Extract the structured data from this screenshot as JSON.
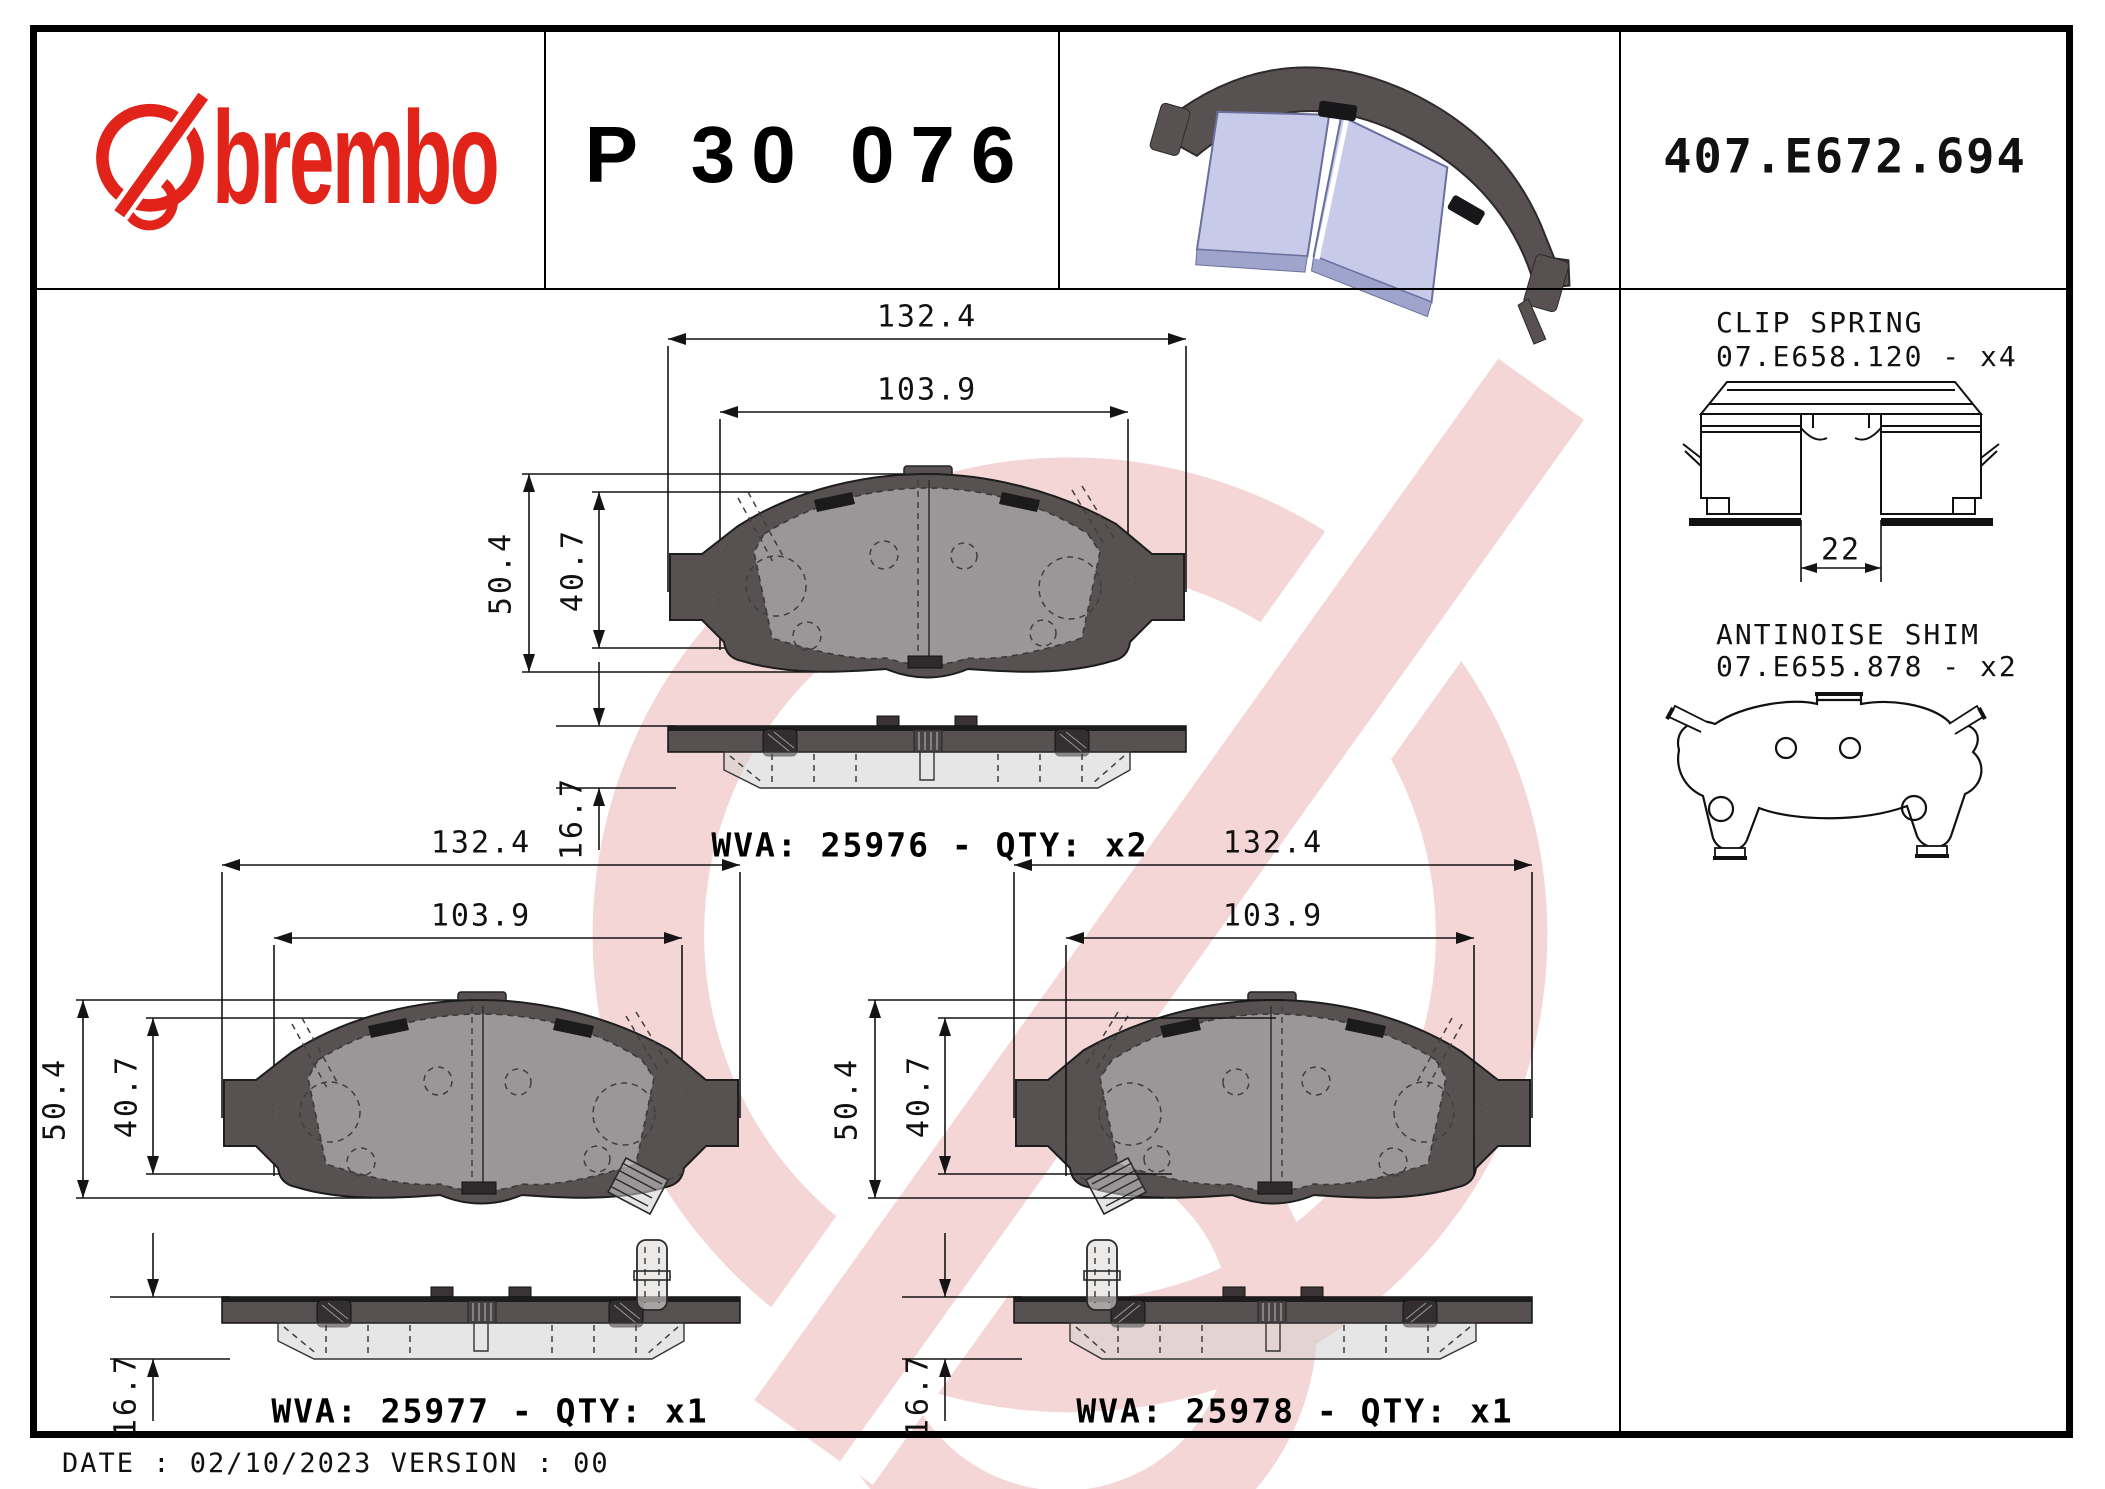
{
  "header": {
    "brand_word": "brembo",
    "part_number": "P 30 076",
    "catalog_code": "407.E672.694"
  },
  "pads": [
    {
      "wva_label": "WVA: 25976 - QTY: x2",
      "dim_width_outer": "132.4",
      "dim_width_inner": "103.9",
      "dim_height_outer": "50.4",
      "dim_height_inner": "40.7",
      "dim_thickness": "16.7"
    },
    {
      "wva_label": "WVA: 25977 - QTY: x1",
      "dim_width_outer": "132.4",
      "dim_width_inner": "103.9",
      "dim_height_outer": "50.4",
      "dim_height_inner": "40.7",
      "dim_thickness": "16.7"
    },
    {
      "wva_label": "WVA: 25978 - QTY: x1",
      "dim_width_outer": "132.4",
      "dim_width_inner": "103.9",
      "dim_height_outer": "50.4",
      "dim_height_inner": "40.7",
      "dim_thickness": "16.7"
    }
  ],
  "accessories": {
    "clip_spring": {
      "title": "CLIP SPRING",
      "code": "07.E658.120 - x4",
      "dim_width": "22"
    },
    "antinoise_shim": {
      "title": "ANTINOISE SHIM",
      "code": "07.E655.878 - x2"
    }
  },
  "footer": {
    "date_version_line": "DATE : 02/10/2023 VERSION : 00"
  },
  "colors": {
    "brand_red": "#e2231a",
    "watermark_pink": "#f5d6d6",
    "backplate_gray": "#585152",
    "friction_gray": "#d9d7d6",
    "pad3d_lavender": "#c7cae8"
  }
}
